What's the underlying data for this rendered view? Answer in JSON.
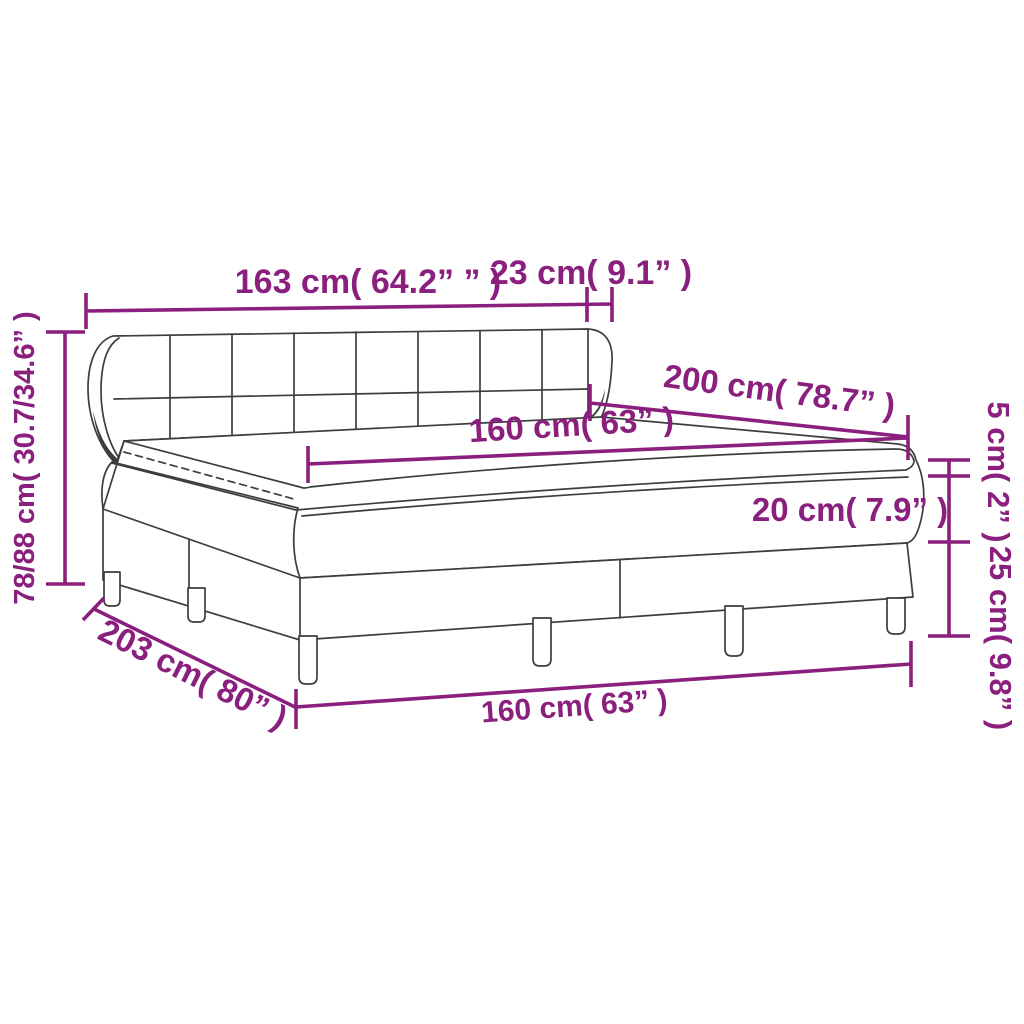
{
  "diagram": {
    "title": "box-spring-bed-dimension-diagram",
    "accent_color": "#8a1f7e",
    "line_color": "#3d3d3d",
    "dimensions": {
      "headboard_width": "163 cm( 64.2” ” )",
      "headboard_depth": "23 cm( 9.1” )",
      "bed_length": "200 cm( 78.7” )",
      "mattress_width_top": "160 cm( 63” )",
      "topper_height": "5 cm( 2” )",
      "mattress_height": "20 cm( 7.9” )",
      "base_height": "25 cm( 9.8” )",
      "headboard_height": "78/88 cm( 30.7/34.6” )",
      "total_length": "203 cm( 80” )",
      "bed_width_bottom": "160 cm( 63” )"
    }
  }
}
